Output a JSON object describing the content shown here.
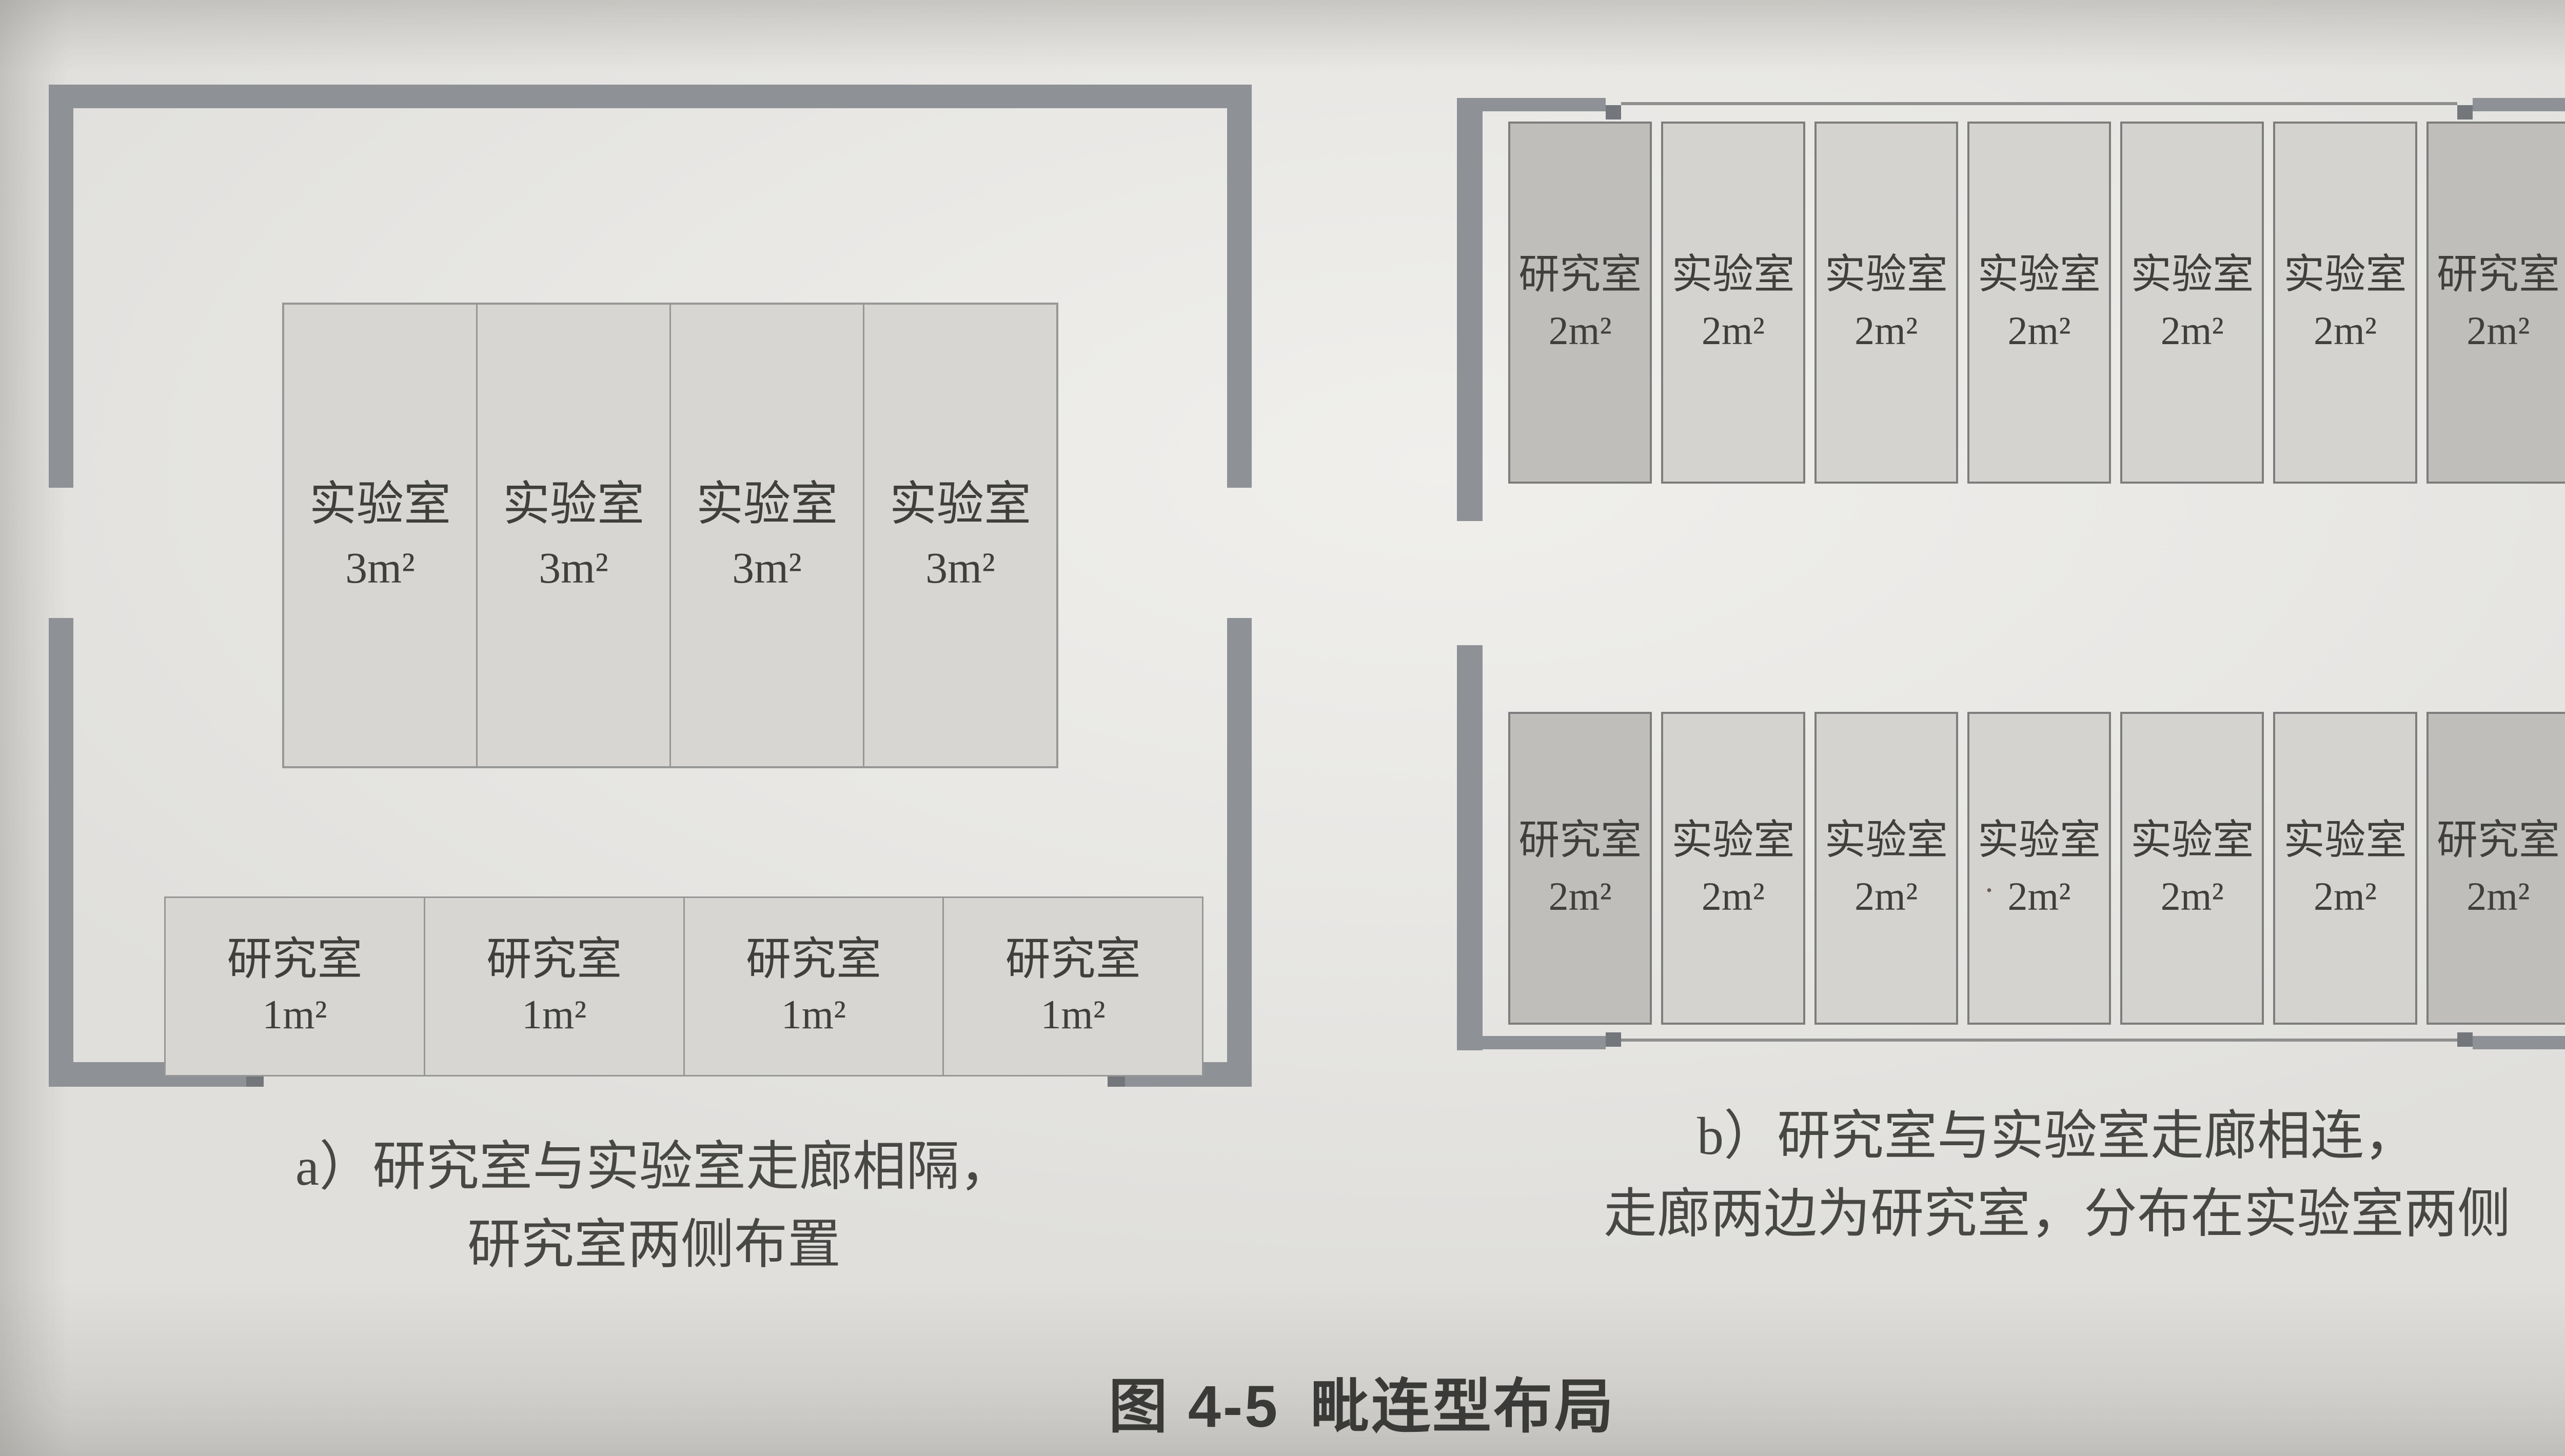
{
  "figure": {
    "label": "图 4-5",
    "title": "毗连型布局"
  },
  "diagram_a": {
    "caption_line1": "a）研究室与实验室走廊相隔，",
    "caption_line2": "研究室两侧布置",
    "lab_rooms": [
      {
        "name": "实验室",
        "area": "3m²"
      },
      {
        "name": "实验室",
        "area": "3m²"
      },
      {
        "name": "实验室",
        "area": "3m²"
      },
      {
        "name": "实验室",
        "area": "3m²"
      }
    ],
    "research_rooms": [
      {
        "name": "研究室",
        "area": "1m²"
      },
      {
        "name": "研究室",
        "area": "1m²"
      },
      {
        "name": "研究室",
        "area": "1m²"
      },
      {
        "name": "研究室",
        "area": "1m²"
      }
    ]
  },
  "diagram_b": {
    "caption_line1": "b）研究室与实验室走廊相连，",
    "caption_line2": "走廊两边为研究室，分布在实验室两侧",
    "top_row": [
      {
        "name": "研究室",
        "area": "2m²",
        "tone": "dark"
      },
      {
        "name": "实验室",
        "area": "2m²",
        "tone": "light"
      },
      {
        "name": "实验室",
        "area": "2m²",
        "tone": "light"
      },
      {
        "name": "实验室",
        "area": "2m²",
        "tone": "light"
      },
      {
        "name": "实验室",
        "area": "2m²",
        "tone": "light"
      },
      {
        "name": "实验室",
        "area": "2m²",
        "tone": "light"
      },
      {
        "name": "研究室",
        "area": "2m²",
        "tone": "dark"
      }
    ],
    "bottom_row": [
      {
        "name": "研究室",
        "area": "2m²",
        "tone": "dark"
      },
      {
        "name": "实验室",
        "area": "2m²",
        "tone": "light"
      },
      {
        "name": "实验室",
        "area": "2m²",
        "tone": "light"
      },
      {
        "name": "实验室",
        "area": "2m²",
        "tone": "light",
        "dot": true
      },
      {
        "name": "实验室",
        "area": "2m²",
        "tone": "light"
      },
      {
        "name": "实验室",
        "area": "2m²",
        "tone": "light"
      },
      {
        "name": "研究室",
        "area": "2m²",
        "tone": "dark"
      }
    ]
  },
  "colors": {
    "wall": "#8e9195",
    "wall_jamb": "#73767a",
    "thin_line": "#8f8f8f",
    "room_fill_a": "#d7d6d3",
    "room_border_a": "#979797",
    "room_fill_lab_b": "#d4d3d0",
    "room_fill_research_b": "#bfbebb",
    "room_border_b": "#7d7d7d",
    "room_text": "#3f3f3d",
    "caption_text": "#474745",
    "figure_text": "#3a3a38",
    "page_bg": "#e8e7e4"
  }
}
